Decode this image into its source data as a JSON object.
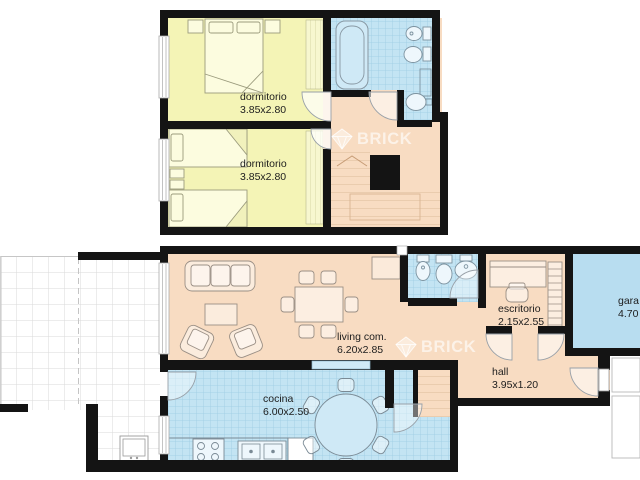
{
  "floors": {
    "upper": {
      "rooms": {
        "dorm1": {
          "label": "dormitorio",
          "dims": "3.85x2.80"
        },
        "dorm2": {
          "label": "dormitorio",
          "dims": "3.85x2.80"
        }
      }
    },
    "lower": {
      "rooms": {
        "living": {
          "label": "living com.",
          "dims": "6.20x2.85"
        },
        "cocina": {
          "label": "cocina",
          "dims": "6.00x2.50"
        },
        "escritorio": {
          "label": "escritorio",
          "dims": "2.15x2.55"
        },
        "hall": {
          "label": "hall",
          "dims": "3.95x1.20"
        },
        "garage": {
          "label": "gara",
          "dims": "4.70"
        }
      }
    }
  },
  "watermark": {
    "text": "BRICK",
    "logo": "diamond-gem-icon",
    "color": "#ffffff"
  },
  "symbols": [
    "bathtub",
    "toilet",
    "bidet",
    "sink",
    "vanity",
    "double-bed",
    "twin-bed",
    "nightstand",
    "wardrobe",
    "stairs",
    "sofa",
    "armchair",
    "coffee-table",
    "dining-table",
    "chair",
    "cabinet",
    "desk",
    "desk-chair",
    "bookshelf",
    "stove",
    "kitchen-sink",
    "fridge",
    "round-table",
    "laundry-tub",
    "door-swing",
    "window",
    "glass-door"
  ],
  "colors": {
    "wall": "#141414",
    "bedroom_floor": "#f4f4b6",
    "wood_floor": "#f8dcc2",
    "tile_floor": "#c3e4f3",
    "tile_line": "#9dcce3",
    "garage_floor": "#b8ddf0",
    "courtyard_line": "#dadada",
    "stair_tread_line": "#d9b795"
  }
}
